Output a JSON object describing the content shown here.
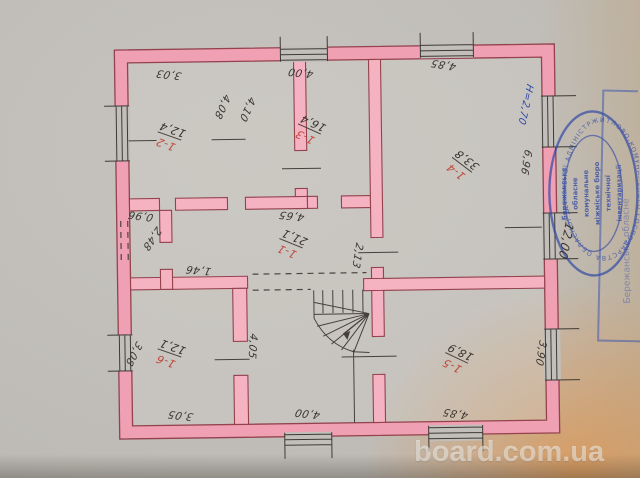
{
  "photo": {
    "watermark_text": "board.com.ua"
  },
  "plan": {
    "rooms": [
      {
        "id": "1-2",
        "area": "12,4"
      },
      {
        "id": "1-3",
        "area": "16,4"
      },
      {
        "id": "1-4",
        "area": "33,8"
      },
      {
        "id": "1-1",
        "area": "21,1"
      },
      {
        "id": "1-6",
        "area": "12,1"
      },
      {
        "id": "1-5",
        "area": "18,9"
      }
    ],
    "dimensions": [
      "3,03",
      "4,00",
      "4,85",
      "4,08",
      "4,10",
      "6,96",
      "12,00",
      "0,96",
      "2,48",
      "4,65",
      "2,13",
      "1,46",
      "3,08",
      "4,05",
      "3,05",
      "4,00",
      "4,85",
      "3,90"
    ],
    "height_note": "H=2,70"
  },
  "stamps": {
    "round": {
      "ring_text": "ЖИТЛОВО-КОМУНАЛЬНОГО ГОСПОДАРСТВА ОБЛАСНОЇ ДЕРЖАВНОЇ АДМІНІСТРАЦІЇ",
      "center_lines": [
        "Бережанське",
        "обласне",
        "комунальне",
        "міжміське бюро",
        "технічної",
        "інвентаризації"
      ]
    },
    "side": {
      "text": "Бережанське обласне"
    }
  },
  "colors": {
    "wall_pink": "#f0a0b3",
    "wall_outline": "#93424e",
    "ink": "#413c37",
    "red_ink": "#c0483c",
    "stamp_blue": "#2d46a5",
    "paper": "#c2bfba"
  }
}
